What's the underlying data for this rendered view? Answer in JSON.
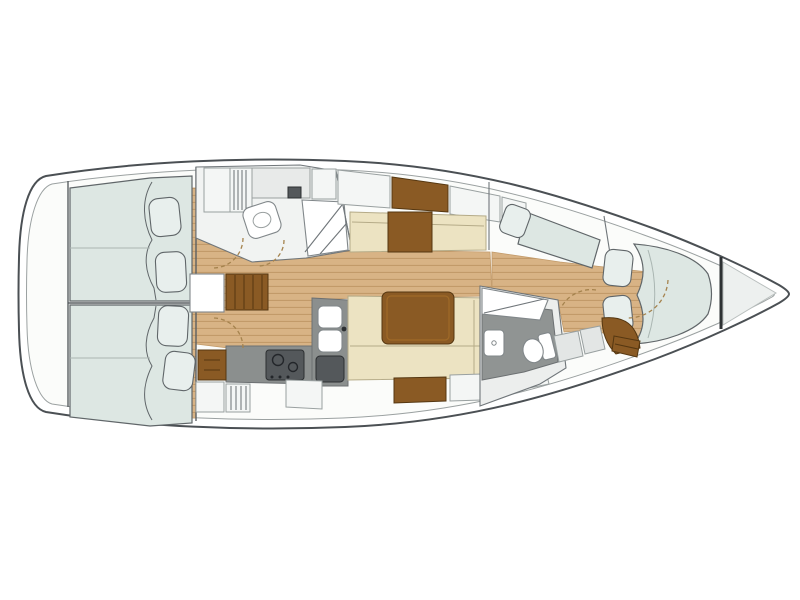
{
  "diagram": {
    "type": "sailing-yacht-interior-floor-plan",
    "orientation": "bow-right-stern-left",
    "text_labels": [],
    "areas": [
      {
        "id": "swim-platform",
        "label": "Stern swim platform",
        "features": [
          "rounded transom"
        ]
      },
      {
        "id": "aft-cabin-port",
        "label": "Aft cabin port",
        "features": [
          "double berth",
          "2 pillows",
          "duvet folds",
          "door swing"
        ]
      },
      {
        "id": "aft-cabin-starboard",
        "label": "Aft cabin starboard",
        "features": [
          "double berth",
          "2 pillows",
          "duvet folds",
          "door swing"
        ]
      },
      {
        "id": "companionway",
        "label": "Companionway",
        "features": [
          "steps",
          "engine access hatch"
        ]
      },
      {
        "id": "aft-head",
        "label": "Aft head (bathroom)",
        "features": [
          "wardrobe",
          "hanging locker",
          "counter",
          "washbasin",
          "shower with grate"
        ]
      },
      {
        "id": "galley",
        "label": "Galley",
        "features": [
          "L-shaped counter",
          "double sink",
          "stove with burners",
          "top-load fridge",
          "drawer cabinet",
          "lockers"
        ]
      },
      {
        "id": "salon",
        "label": "Salon",
        "features": [
          "port settee",
          "sideboard",
          "saloon table",
          "L-shaped settee",
          "hull lockers"
        ]
      },
      {
        "id": "forward-head",
        "label": "Forward head (bathroom)",
        "features": [
          "shower",
          "toilet",
          "washbasin",
          "lockers",
          "door swing"
        ]
      },
      {
        "id": "forward-cabin",
        "label": "Forward cabin",
        "features": [
          "V-berth double bed",
          "2 pillows",
          "port berth with pillow",
          "wood vanity seat",
          "steps"
        ]
      },
      {
        "id": "anchor-locker",
        "label": "Bow anchor locker",
        "features": [
          "collision bulkhead"
        ]
      }
    ]
  },
  "palette": {
    "bg": "#ffffff",
    "hull_line": "#4b5054",
    "inner_line": "#9ba1a1",
    "wall_line": "#5a5f62",
    "deck": "#fbfcfa",
    "floor": "#d8b385",
    "floor_stripe": "#c29a69",
    "wood": "#8a5a24",
    "wood_dark": "#553711",
    "cream": "#ece3c2",
    "cream_line": "#b5ab88",
    "mattress": "#dde7e3",
    "mattress_line": "#606669",
    "pillow": "#e8efed",
    "fixture": "#ffffff",
    "fixture_line": "#81878a",
    "counter": "#8b8f8e",
    "appliance": "#54585b",
    "head_floor": "#909493",
    "locker": "#f4f6f5",
    "locker_line": "#99a0a0",
    "louver": "#6a7073",
    "door_arc": "#a5834e"
  }
}
